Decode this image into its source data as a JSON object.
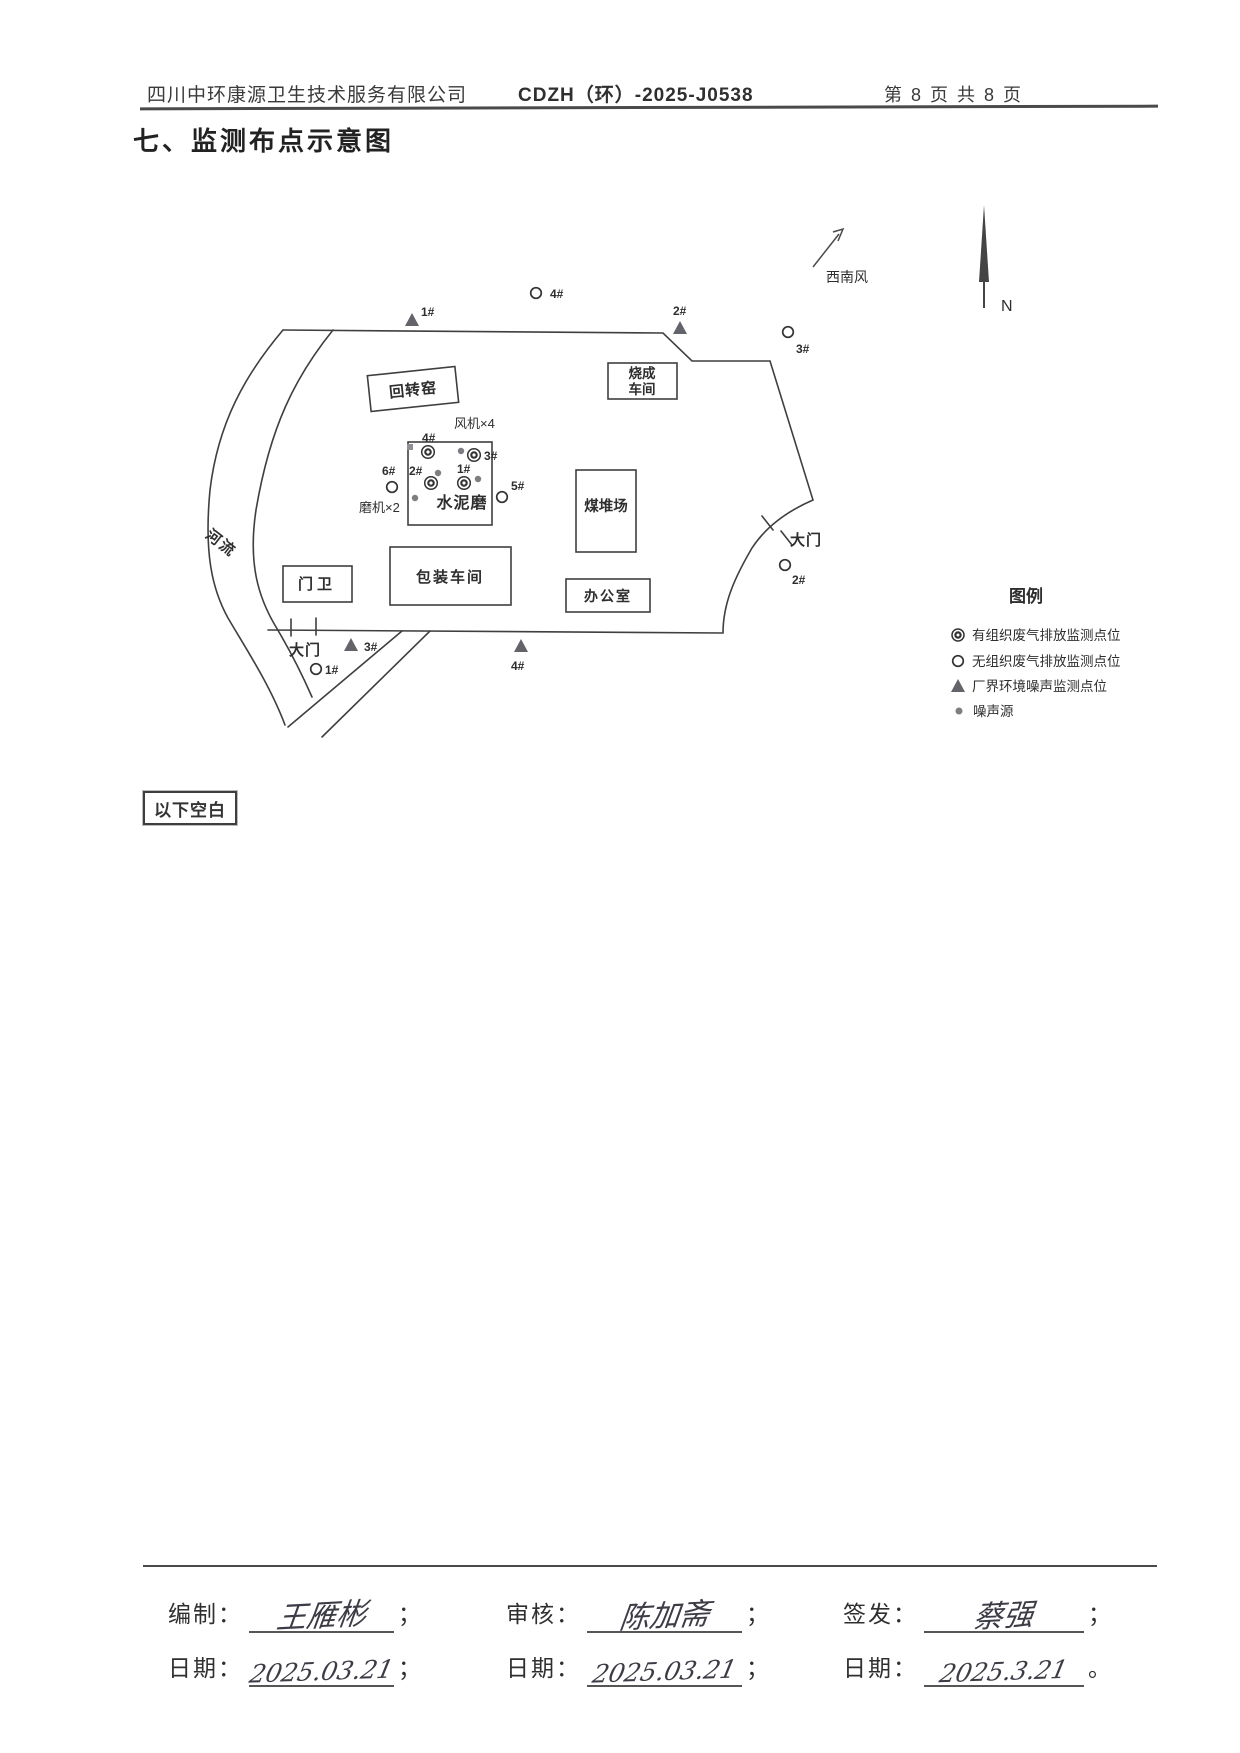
{
  "header": {
    "company": "四川中环康源卫生技术服务有限公司",
    "doc_no": "CDZH（环）-2025-J0538",
    "page_info": "第 8 页 共 8 页"
  },
  "title": "七、监测布点示意图",
  "diagram": {
    "compass_label": "N",
    "wind_label": "西南风",
    "river_label": "河流",
    "gate_left": "大门",
    "gate_right": "大门",
    "buildings": {
      "rotary_kiln": "回转窑",
      "firing_workshop_line1": "烧成",
      "firing_workshop_line2": "车间",
      "cement_mill": "水泥磨",
      "coal_yard": "煤堆场",
      "gate_house": "门卫",
      "packing_workshop": "包装车间",
      "office": "办公室"
    },
    "annotations": {
      "fans": "风机×4",
      "mills": "磨机×2"
    },
    "points": {
      "organized": [
        {
          "label": "1#"
        },
        {
          "label": "2#"
        },
        {
          "label": "3#"
        },
        {
          "label": "4#"
        }
      ],
      "unorganized_inner": [
        {
          "label": "5#"
        },
        {
          "label": "6#"
        }
      ],
      "unorganized_outer": [
        {
          "label": "1#"
        },
        {
          "label": "2#"
        },
        {
          "label": "3#"
        },
        {
          "label": "4#"
        }
      ],
      "noise_boundary": [
        {
          "label": "1#"
        },
        {
          "label": "2#"
        },
        {
          "label": "3#"
        },
        {
          "label": "4#"
        }
      ]
    }
  },
  "legend": {
    "title": "图例",
    "items": [
      {
        "label": "有组织废气排放监测点位"
      },
      {
        "label": "无组织废气排放监测点位"
      },
      {
        "label": "厂界环境噪声监测点位"
      },
      {
        "label": "噪声源"
      }
    ]
  },
  "blank_note": "以下空白",
  "footer": {
    "prepared_label": "编制：",
    "prepared_name": "王雁彬",
    "date_label": "日期：",
    "prepared_date": "2025.03.21",
    "reviewed_label": "审核：",
    "reviewed_name": "陈加斋",
    "reviewed_date": "2025.03.21",
    "issued_label": "签发：",
    "issued_name": "蔡强",
    "issued_date": "2025.3.21",
    "semicolon": "；",
    "period": "。"
  },
  "colors": {
    "line": "#3f3f3f",
    "gray_label": "#9a9a9a",
    "noise_dot": "#7d7d82",
    "triangle": "#63636a"
  }
}
